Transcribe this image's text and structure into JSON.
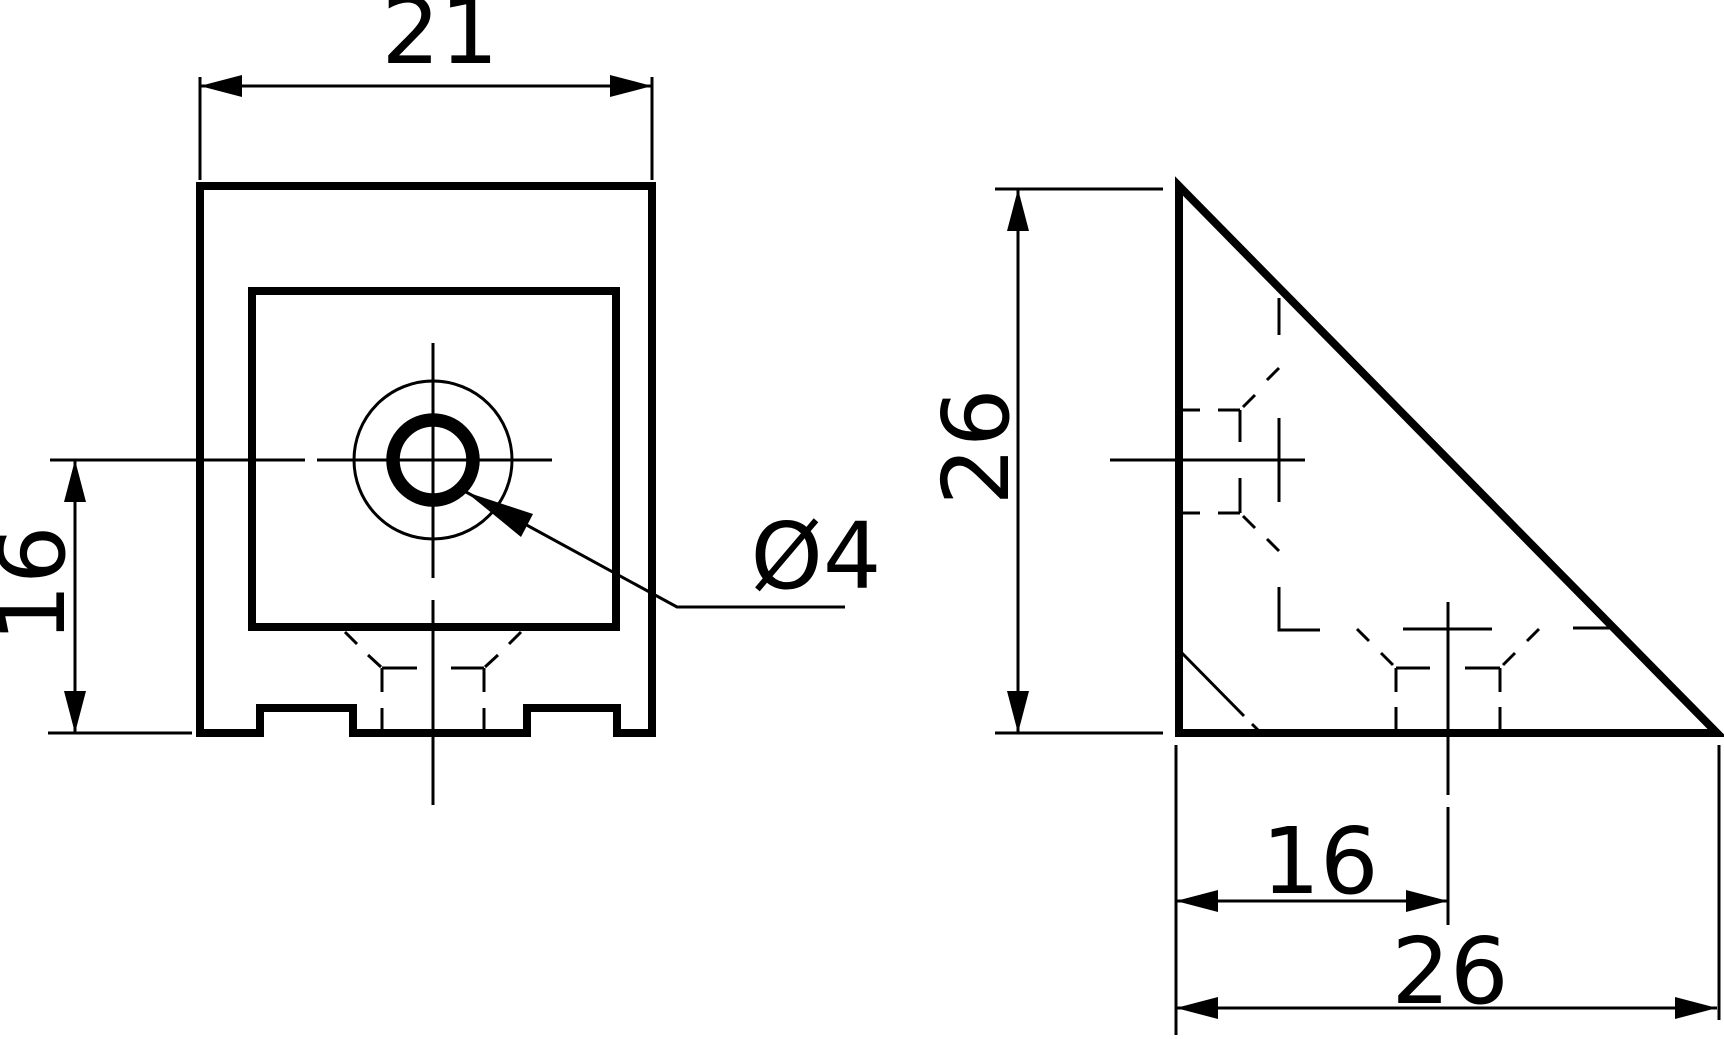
{
  "drawing": {
    "type": "technical-drawing",
    "part": "corner-bracket",
    "colors": {
      "background": "#ffffff",
      "line": "#000000"
    },
    "views": {
      "front": {
        "name": "front-view",
        "dim_width": "21",
        "dim_hole_offset": "16",
        "dim_hole_diameter": "Ø4"
      },
      "side": {
        "name": "side-view",
        "dim_height": "26",
        "dim_hole_offset": "16",
        "dim_depth": "26"
      }
    }
  }
}
